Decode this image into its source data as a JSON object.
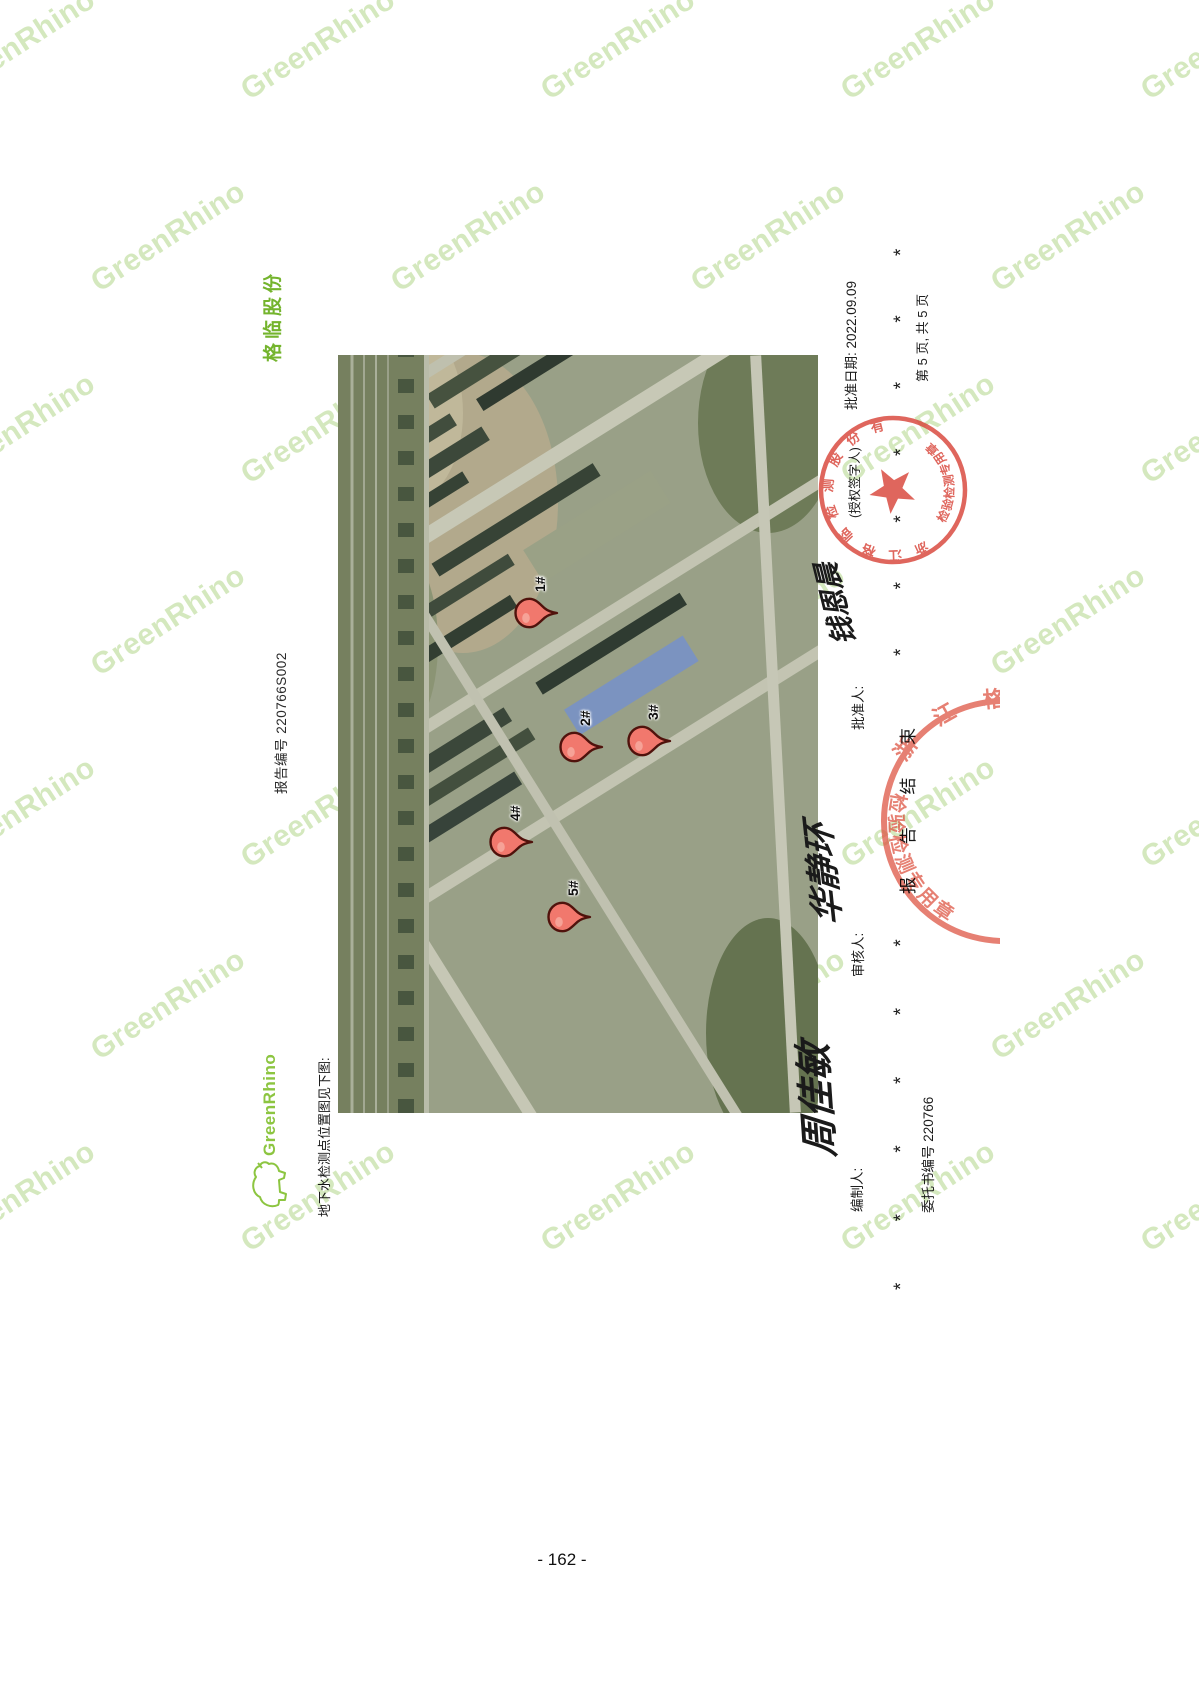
{
  "page": {
    "number": "- 162 -"
  },
  "watermark": {
    "text": "GreenRhino"
  },
  "header": {
    "logo_text": "GreenRhino",
    "caption": "地下水检测点位置图见下图:",
    "report_no": "报告编号 220766S002",
    "company_short": "格临股份"
  },
  "map": {
    "type": "satellite",
    "markers": [
      {
        "label": "1#",
        "x": 500,
        "y": 192
      },
      {
        "label": "2#",
        "x": 366,
        "y": 237
      },
      {
        "label": "3#",
        "x": 372,
        "y": 305
      },
      {
        "label": "4#",
        "x": 271,
        "y": 167
      },
      {
        "label": "5#",
        "x": 196,
        "y": 225
      }
    ]
  },
  "signatures": {
    "preparer_label": "编制人:",
    "preparer_name": "周佳敏",
    "reviewer_label": "审核人:",
    "reviewer_name": "华静环",
    "approver_label": "批准人:",
    "approver_name": "钱恩晨",
    "approver_note": "(授权签字人)",
    "approval_date": "批准日期: 2022.09.09"
  },
  "footer": {
    "commission_no": "委托书编号 220766",
    "asterisks_left": "* * * * * *",
    "report_end": "报 告 结 束",
    "asterisks_right": "* * * * * * *",
    "page_info": "第 5 页, 共 5 页"
  },
  "stamps": {
    "ring_text": "浙江格临检测股份有限公司",
    "bottom_text": "检验检测专用章"
  }
}
